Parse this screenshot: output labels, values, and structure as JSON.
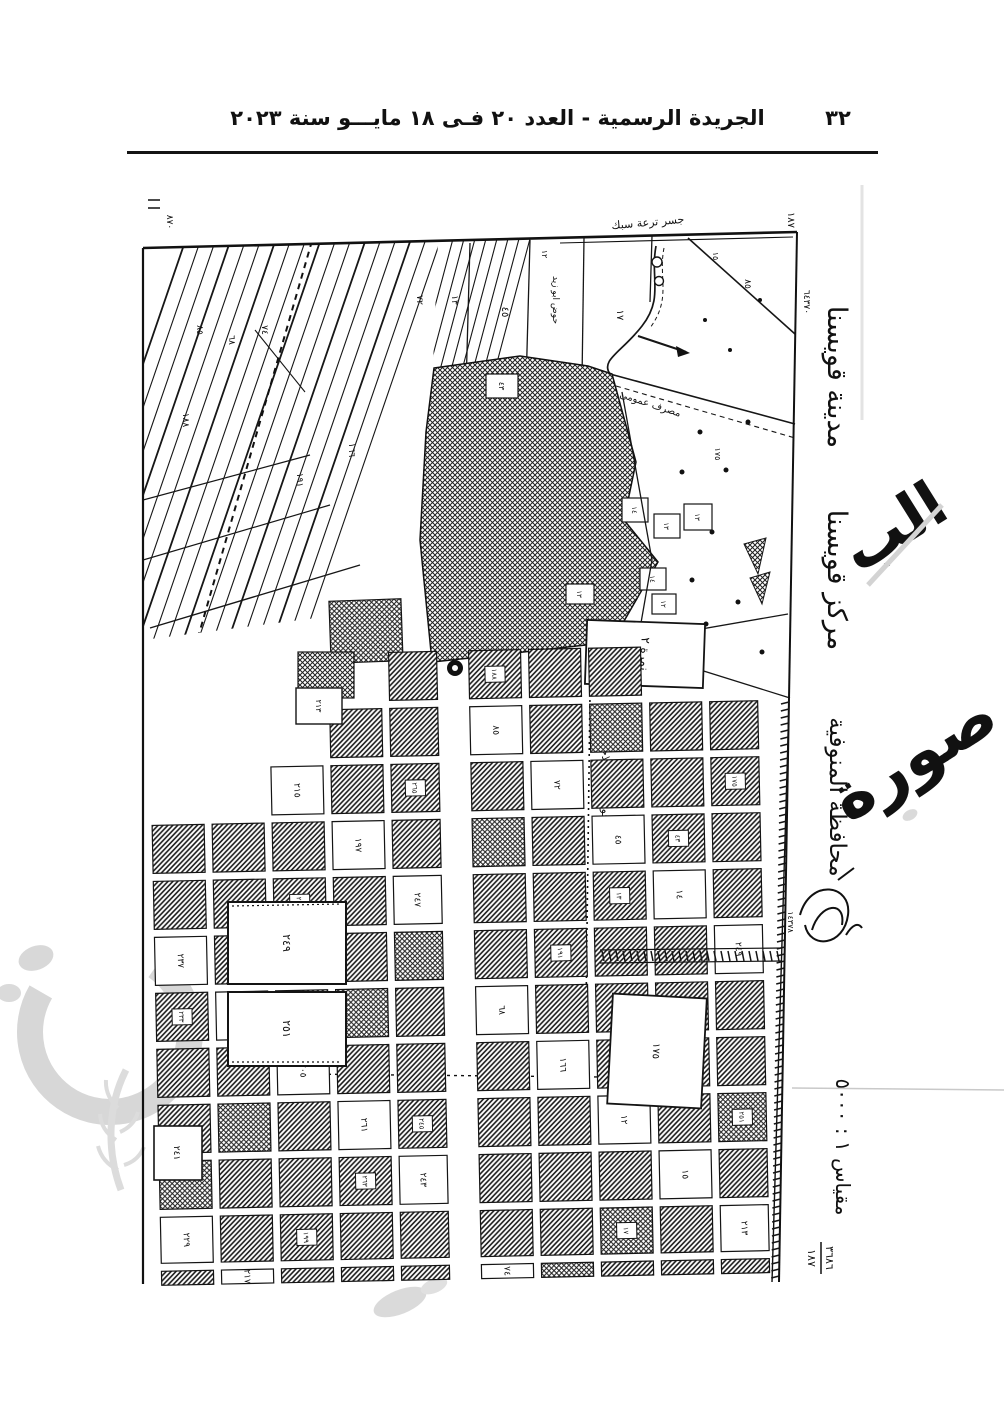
{
  "header": {
    "title": "الجريدة الرسمية - العدد ٢٠ فـى ١٨ مايـــو سنة ٢٠٢٣",
    "page_number": "٣٢"
  },
  "map": {
    "margin": {
      "city": "مدينة قويسنا",
      "district": "مركز قويسنا",
      "governorate": "محافظة المنوفية",
      "scale": "مقياس ١ : ٥٠٠٠",
      "sheet_number": "١٨٧",
      "coord_top": "٦٤٣٧٠",
      "coord_mid": "١٤٣٧٨",
      "corner_left": "٨٧٠",
      "fraction_top": "٣٦٨٦",
      "fraction_bottom": "١٨٧"
    },
    "annotations": {
      "block_box": "نمرة ٢",
      "hod_road": "حوض دار الملاحة نمرة ٢",
      "hod_top": "حوض ابو زيد",
      "top_note": "جسر ترعة سبك",
      "road_note": "مصرف عمومى"
    },
    "plot_numbers": [
      "١٨٨",
      "٨٥",
      "٦٨",
      "٧٤",
      "٧٢",
      "١٩١",
      "١٦٦",
      "٤٥",
      "١٣",
      "١٢",
      "١٧",
      "٤٣",
      "١٤",
      "١٥",
      "١٧٥",
      "٢٤٩",
      "٢٥١",
      "٢١٣",
      "٢٤١",
      "٢٣٧",
      "٢٣٣",
      "٢٢٩",
      "٢٢٧",
      "٢٢٥",
      "٢١٧",
      "٢١٥",
      "٢٠٩",
      "٢٠٥",
      "١٩٩",
      "١٩٧",
      "٢٦١",
      "٢٦٣",
      "٢٦٥",
      "٢٤٧",
      "٢٤٥",
      "٢٤٣"
    ]
  },
  "watermark": {
    "ghost_1": "الب",
    "ghost_2": "صورة"
  }
}
